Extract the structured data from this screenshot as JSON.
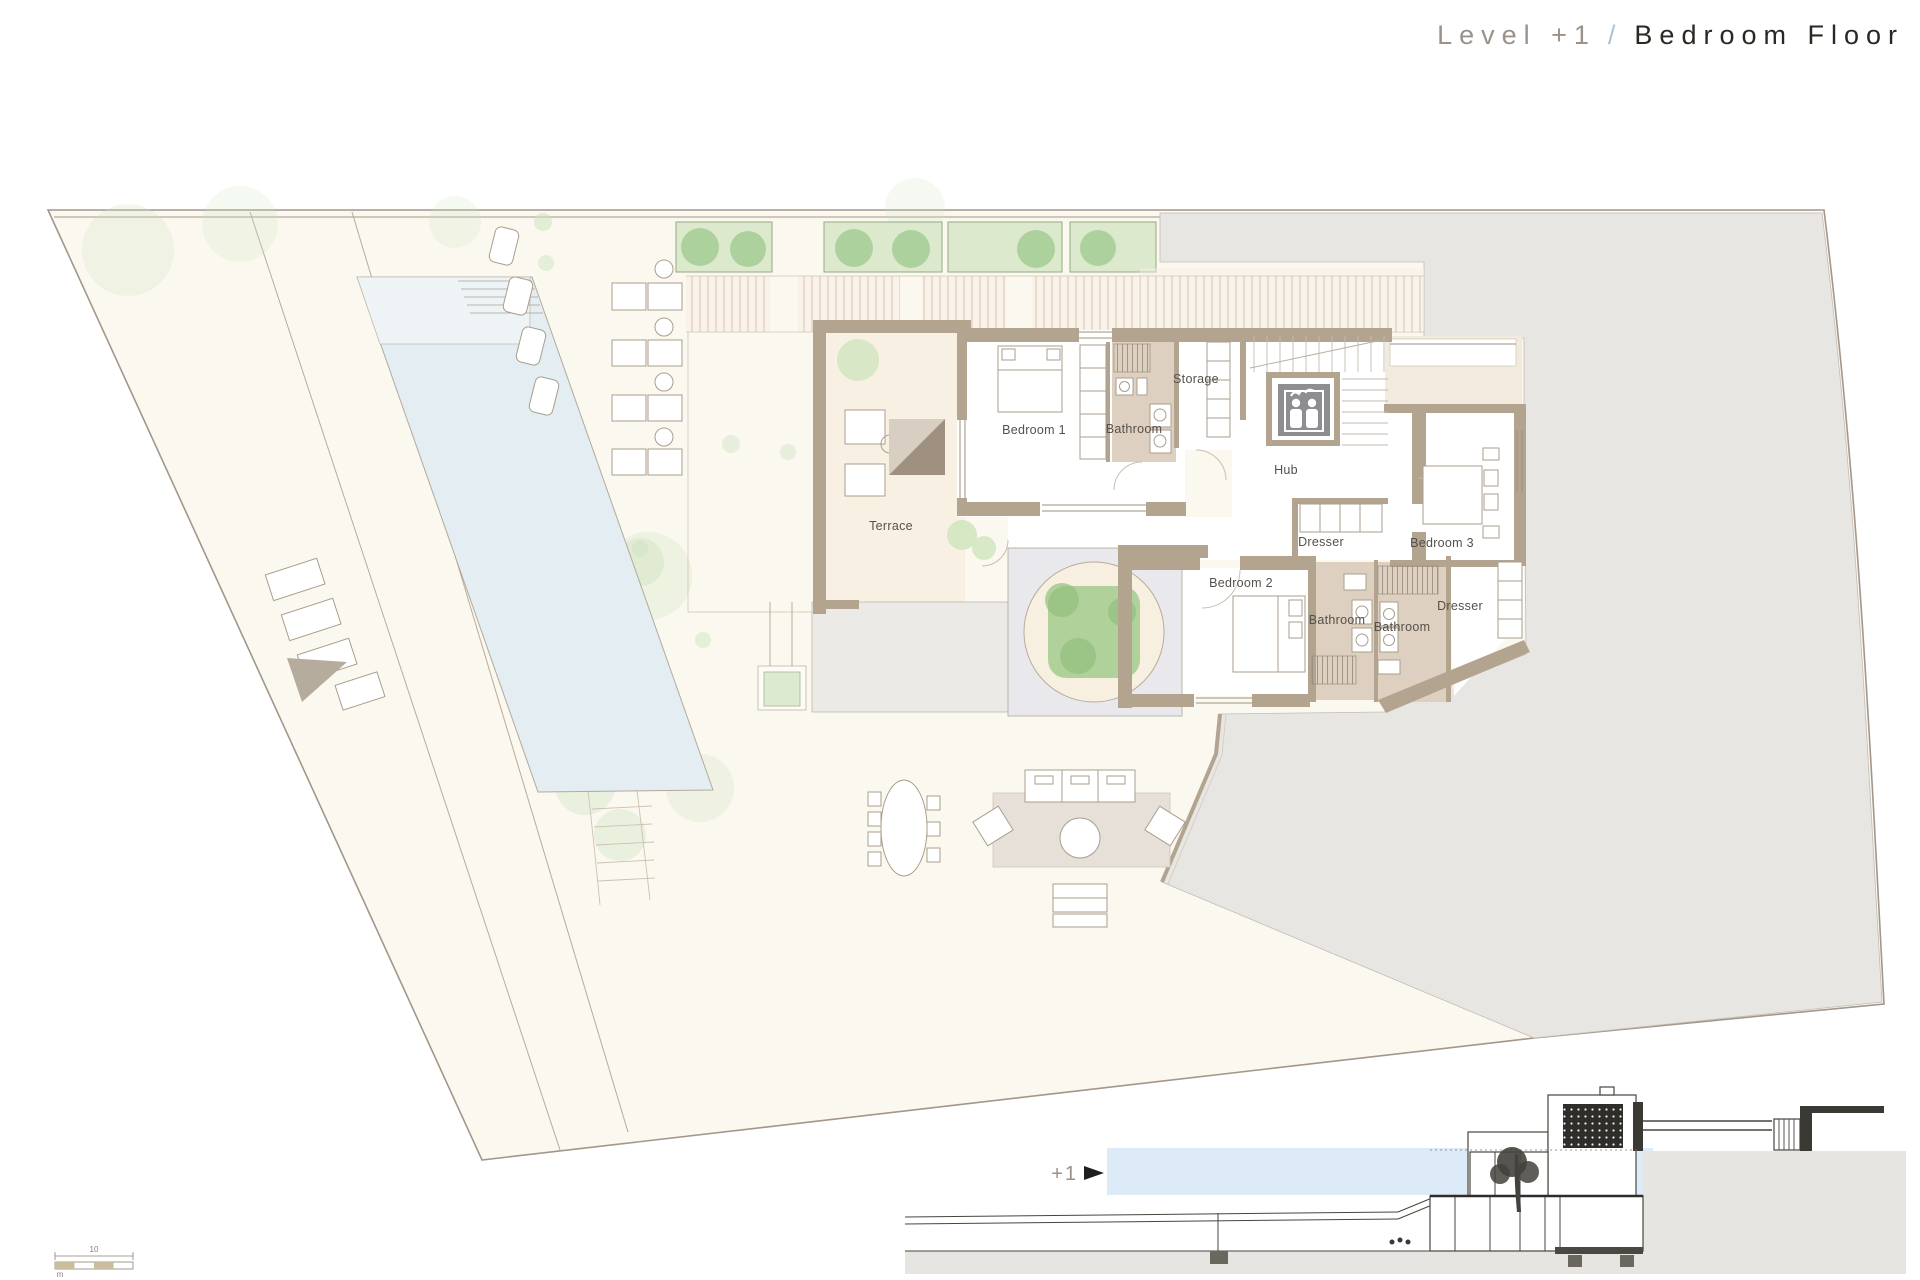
{
  "title": {
    "level": "Level +1",
    "separator": "/",
    "name": "Bedroom Floor"
  },
  "plan": {
    "labels": [
      {
        "label": "Terrace"
      },
      {
        "label": "Bedroom 1"
      },
      {
        "label": "Bathroom"
      },
      {
        "label": "Storage"
      },
      {
        "label": "Hub"
      },
      {
        "label": "Dresser"
      },
      {
        "label": "Bedroom 3"
      },
      {
        "label": "Bedroom 2"
      },
      {
        "label": "Bathroom"
      },
      {
        "label": "Bathroom"
      },
      {
        "label": "Dresser"
      }
    ]
  },
  "section": {
    "level_marker": "+1"
  },
  "scale_bar": {
    "value": "10",
    "unit": "m"
  },
  "colors": {
    "site": "#fbf8f0",
    "terrain": "#e8e6e2",
    "wall": "#b3a48f",
    "bathroom_floor": "#ded0c0",
    "pool": "#e4edf1",
    "planter_box": "#dce9cd",
    "shrub": "#a9cf97",
    "water_band": "#dcebf7",
    "title_accent": "#a9c3d3"
  }
}
